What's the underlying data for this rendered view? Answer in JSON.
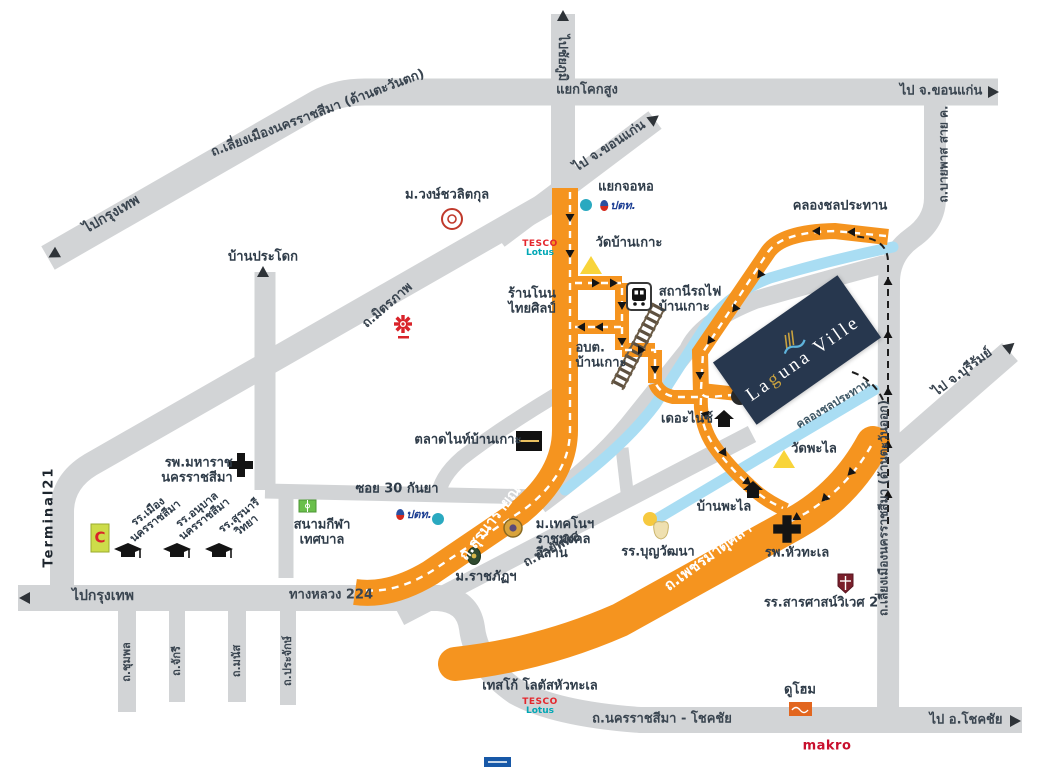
{
  "map": {
    "project": {
      "name": "Laguna Ville",
      "laguna": {
        "pre": "La",
        "g": "g",
        "post": "una Ville",
        "full": "Laguna Ville"
      },
      "colors": {
        "road_gray": "#d2d4d6",
        "road_orange": "#f5941f",
        "canal": "#a9ddf3",
        "laguna_navy": "#27374e",
        "laguna_gold": "#c9a23f",
        "temple_yellow": "#f8d43a"
      }
    },
    "directions": {
      "to_bangkok_nw": "ไปกรุงเทพ",
      "to_chaiyaphum": "ไปชัยภูมิ",
      "to_khonkaen_top": "ไป จ.ขอนแก่น",
      "to_khonkaen_spur": "ไป จ.ขอนแก่น",
      "to_buriram": "ไป จ.บุรีรัมย์",
      "to_bangkok_sw": "ไปกรุงเทพ",
      "to_chokchai": "ไป อ.โชคชัย"
    },
    "junctions": {
      "khok_sung": "แยกโคกสูง",
      "jo_ho": "แยกจอหอ"
    },
    "roads": {
      "west_bypass": "ถ.เลี่ยงเมืองนครราชสีมา (ด้านตะวันตก)",
      "east_bypass": "ถ.เลี่ยงเมืองนครราชสีมา (ด้านตะวันออก)",
      "mittraphap": "ถ.มิตรภาพ",
      "bypass_line_c": "ถ.บายพาส สาย ค.",
      "suranarai": "ถ.สุรนารายณ์",
      "phetmatukla": "ถ.เพชรมาตุคลา",
      "phayapthit": "ถ.พายัพทิศ",
      "highway224": "ทางหลวง 224",
      "soi30": "ซอย 30 กันยา",
      "chumphon": "ถ.ชุมพล",
      "chakri": "ถ.จักรี",
      "manat": "ถ.มนัส",
      "prajak": "ถ.ประจักษ์",
      "korat_chokchai": "ถ.นครราชสีมา - โชคชัย",
      "canal_top": "คลองชลประทาน",
      "canal_lower": "คลองชลประทาน"
    },
    "places": {
      "ban_pradok": "บ้านประโดก",
      "wongchavalitkul": "ม.วงษ์ชวลิตกุล",
      "wat_ban_ko": "วัดบ้านเกาะ",
      "ran_non_thai_sin": "ร้านโนน\nไทยศิลป์",
      "train_station": "สถานีรถไฟ\nบ้านเกาะ",
      "obt_ban_ko": "อบต.\nบ้านเกาะ",
      "night_market": "ตลาดไนท์บ้านเกาะ",
      "the_nice": "เดอะไนซ์",
      "wat_phalai": "วัดพะไล",
      "ban_phalai": "บ้านพะไล",
      "boonwattana": "รร.บุญวัฒนา",
      "rmuti": "ม.เทคโนฯ\nราชมงคล\nอีสาน",
      "rajabhat": "ม.ราชภัฏฯ",
      "maharat_hospital": "รพ.มหาราช\nนครราชสีมา",
      "terminal21": "Terminal21",
      "muang_school": "รร.เมือง\nนครราชสีมา",
      "anuban_school": "รร.อนุบาล\nนครราชสีมา",
      "suranari_school": "รร.สุรนารี\nวิทยา",
      "stadium": "สนามกีฬา\nเทศบาล",
      "huathale_hospital": "รพ.หัวทะเล",
      "sarasas_school": "รร.สารศาสน์วิเวศ 2",
      "duhome": "ดูโฮม",
      "tesco_huathale": "เทสโก้ โลตัสหัวทะเล",
      "makro": "makro"
    },
    "logos": {
      "tesco_1": "TESCO",
      "tesco_2": "Lotus",
      "ptt": "ปตท.",
      "klang_c": "C"
    }
  }
}
